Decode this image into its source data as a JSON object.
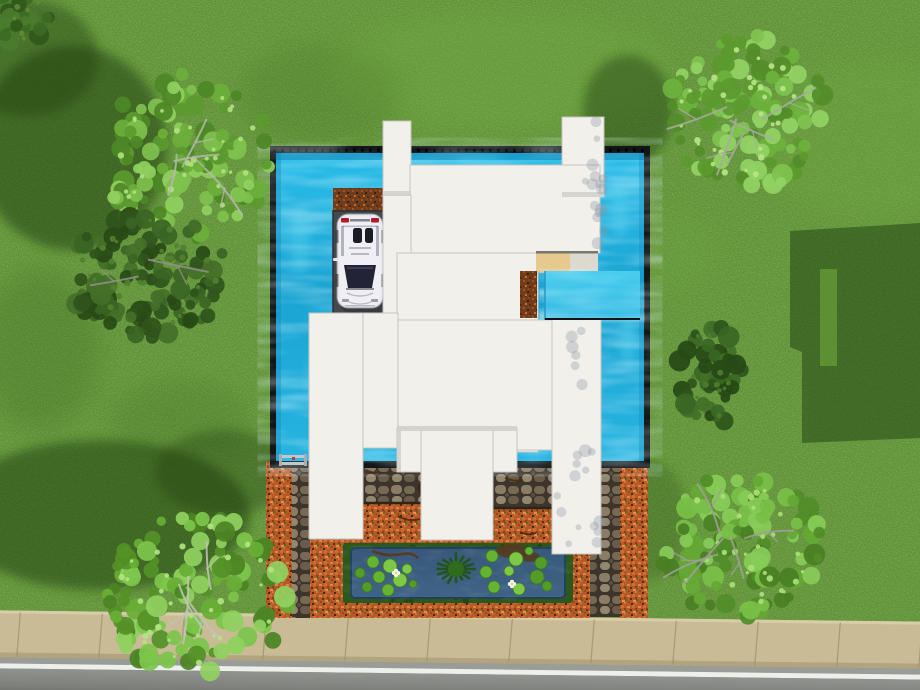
{
  "scene": {
    "width": 920,
    "height": 690,
    "terrain": {
      "grass_base": "#5d9034",
      "grass_light": "#76ad45",
      "grass_dark": "#3f6a22",
      "blotches": [
        [
          500,
          70,
          170,
          60,
          "L",
          0.3
        ],
        [
          870,
          140,
          110,
          80,
          "L",
          0.25
        ],
        [
          420,
          645,
          90,
          28,
          "L",
          0.2
        ],
        [
          660,
          250,
          60,
          40,
          "L",
          0.18
        ],
        [
          320,
          95,
          80,
          50,
          "D",
          0.2
        ],
        [
          180,
          420,
          70,
          40,
          "D",
          0.22
        ],
        [
          40,
          350,
          60,
          80,
          "D",
          0.28
        ]
      ]
    },
    "shadows": {
      "color": "#1c3a0e",
      "blobs": [
        [
          72,
          148,
          95,
          102,
          0.5
        ],
        [
          28,
          58,
          70,
          58,
          0.4
        ],
        [
          628,
          110,
          45,
          55,
          0.42
        ],
        [
          100,
          515,
          150,
          75,
          0.5
        ],
        [
          225,
          472,
          70,
          42,
          0.35
        ],
        [
          648,
          520,
          40,
          60,
          0.22
        ]
      ],
      "house_shadow_path": "M790,231 L920,223 L920,438 L802,443 L802,352 L790,347 Z",
      "house_shadow_opacity": 0.48,
      "slot": [
        820,
        269,
        17,
        97
      ],
      "slot_color": "#5f9233"
    },
    "street": {
      "rotate": 0.7,
      "sidewalk": [
        -10,
        616,
        940,
        48
      ],
      "sidewalk_color": "#c9bb95",
      "lip_color": "#d9cda9",
      "shade_color": "#b2a47e",
      "joint_color": "#a2946f",
      "joint_start": 20,
      "joint_step": 82,
      "curb": [
        -10,
        663,
        940,
        6
      ],
      "curb_color": "#9a9c98",
      "line": [
        -10,
        669,
        940,
        5
      ],
      "line_color": "#edefec",
      "asphalt": [
        -10,
        674,
        940,
        30
      ],
      "asphalt_top": "#90938f",
      "asphalt_bottom": "#5e615a"
    },
    "pool": {
      "frame": [
        270,
        146,
        380,
        322
      ],
      "frame_color": "#12161a",
      "water": [
        276,
        153,
        368,
        308
      ],
      "water_top": "#2abde9",
      "water_mid": "#1ba4d2",
      "water_bottom": "#27b4e1",
      "tick_y": 150.5,
      "inner_shadow_color": "#0b84b4",
      "streak_color": "#63d8f4",
      "streaks": [
        [
          300,
          240,
          10,
          34
        ],
        [
          316,
          380,
          8,
          28
        ],
        [
          620,
          210,
          9,
          30
        ],
        [
          628,
          340,
          8,
          26
        ],
        [
          480,
          160,
          26,
          5
        ],
        [
          535,
          456,
          14,
          4
        ],
        [
          380,
          455,
          12,
          4
        ]
      ],
      "inlet": [
        545,
        271,
        95,
        49
      ],
      "inlet_top": "#49cdef",
      "inlet_bottom": "#2fb9e2",
      "ladder": {
        "x": 281,
        "y": 452,
        "rail": "#c3c6ca",
        "post": "#a9acb0",
        "accent": "#c0392b"
      }
    },
    "ground": {
      "mulch": [
        [
          266,
          462,
          26,
          156
        ],
        [
          310,
          462,
          280,
          156
        ],
        [
          620,
          468,
          28,
          150
        ]
      ],
      "stone": [
        [
          292,
          464,
          18,
          154
        ],
        [
          360,
          464,
          64,
          40
        ],
        [
          490,
          467,
          64,
          42
        ],
        [
          590,
          468,
          30,
          149
        ]
      ],
      "edging": [
        [
          360,
          503,
          424,
          503
        ],
        [
          490,
          508,
          554,
          508
        ]
      ],
      "edging_color": "#2f2517",
      "debris_color": "#4a2a10",
      "debris": [
        "M330,492 q8,5 16,2",
        "M398,516 q10,6 22,3",
        "M505,478 q9,4 18,2",
        "M520,532 q8,4 16,1",
        "M366,470 q7,4 14,2"
      ],
      "leaf_clump": [
        428,
        489,
        11,
        8
      ],
      "leaf_color": "#2c2314"
    },
    "pond": {
      "border": [
        343,
        543,
        230,
        60
      ],
      "border_color": "#2b591b",
      "border_dot": "#1e4312",
      "water": [
        351,
        548,
        214,
        50
      ],
      "water_top": "#37587a",
      "water_bottom": "#3f6386",
      "water_edge": "#24415c",
      "pad_colors": [
        "#64b431",
        "#7dc947",
        "#529c27"
      ],
      "pad_stroke": "#3c7c1d",
      "pads_left": [
        [
          373,
          562,
          6
        ],
        [
          390,
          566,
          7
        ],
        [
          360,
          573,
          5
        ],
        [
          379,
          577,
          6
        ],
        [
          400,
          580,
          7
        ],
        [
          367,
          587,
          5
        ],
        [
          388,
          590,
          6
        ],
        [
          407,
          569,
          5
        ],
        [
          413,
          584,
          4
        ]
      ],
      "pads_right": [
        [
          492,
          556,
          6
        ],
        [
          516,
          559,
          7
        ],
        [
          541,
          563,
          6
        ],
        [
          486,
          572,
          6
        ],
        [
          509,
          571,
          5
        ],
        [
          537,
          577,
          7
        ],
        [
          494,
          587,
          6
        ],
        [
          519,
          589,
          6
        ],
        [
          547,
          586,
          5
        ],
        [
          529,
          551,
          4
        ]
      ],
      "plant": {
        "cx": 456,
        "cy": 569,
        "spikes": 16,
        "r1": 8,
        "r2": 24,
        "color": "#1f5313",
        "core": "#2e6b1a"
      },
      "flowers": [
        [
          396,
          573
        ],
        [
          512,
          584
        ]
      ],
      "flower_color": "#f2f4ee",
      "flower_center": "#e8d44a",
      "twig_color": "#58391b",
      "twigs": [
        "M372,551 q14,6 30,3 q10,-2 16,4",
        "M497,548 q16,8 34,6"
      ],
      "twig_blobs": [
        [
          512,
          551,
          16,
          7
        ],
        [
          530,
          557,
          10,
          5
        ]
      ]
    },
    "driveway": {
      "rect": [
        333,
        211,
        53,
        104
      ],
      "color": "#45494e",
      "edge_color": "#2c2f33",
      "dirt_top": [
        333,
        188,
        53,
        24
      ]
    },
    "car": {
      "x": 337,
      "y": 214,
      "w": 46,
      "h": 94,
      "body": "#e7e7ed",
      "body_hi": "#f1f1f6",
      "outline": "#94959e",
      "glass": "#232338",
      "seat": "#1c1c26",
      "tail": "#b01c26",
      "trim": "#b9bac3",
      "light": "#9a9ba6",
      "wheel": "#1e1e1e"
    },
    "house": {
      "fill": "#f1f0ea",
      "stroke": "#c6c5c0",
      "rects": [
        [
          383,
          121,
          28,
          75,
          "tower-left"
        ],
        [
          562,
          117,
          42,
          80,
          "tower-right"
        ],
        [
          410,
          165,
          190,
          88,
          "roof-top-slab"
        ],
        [
          383,
          195,
          28,
          253,
          "roof-left-column"
        ],
        [
          397,
          253,
          141,
          199,
          "roof-main"
        ],
        [
          397,
          320,
          155,
          130,
          "roof-main-lower"
        ],
        [
          309,
          313,
          54,
          226,
          "wing-left"
        ],
        [
          363,
          313,
          35,
          135,
          "roof-left-mid"
        ],
        [
          552,
          318,
          49,
          236,
          "wing-right"
        ],
        [
          397,
          428,
          120,
          44,
          "roof-center-ext"
        ],
        [
          421,
          428,
          72,
          112,
          "roof-center-lower"
        ]
      ],
      "seams": [
        [
          411,
          196,
          411,
          252
        ],
        [
          363,
          314,
          363,
          447
        ],
        [
          364,
          313,
          397,
          313
        ],
        [
          410,
          253,
          536,
          253
        ],
        [
          552,
          320,
          552,
          450
        ]
      ],
      "bands": [
        [
          397,
          426,
          120,
          5
        ],
        [
          397,
          426,
          4,
          46
        ],
        [
          384,
          191,
          27,
          5
        ],
        [
          562,
          192,
          42,
          5
        ]
      ],
      "band_color": "#d2d1cc",
      "deck": {
        "base": [
          536,
          252,
          62,
          21
        ],
        "left_color": "#e5c98e",
        "right_color": "#dcd9cf",
        "top_color": "#77776f",
        "bottom_color": "#bdbcb6"
      },
      "dirt_strip": [
        520,
        271,
        17,
        47
      ],
      "dapple_color": "#8e95a3",
      "dapples": [
        [
          556,
          448,
          44,
          96,
          14,
          91
        ],
        [
          584,
          120,
          20,
          72,
          9,
          92
        ],
        [
          594,
          196,
          12,
          48,
          6,
          93
        ],
        [
          566,
          330,
          26,
          60,
          6,
          94
        ]
      ]
    },
    "trees": [
      {
        "name": "tree-top-left",
        "cx": 187,
        "cy": 158,
        "rx": 92,
        "ry": 92,
        "seed": 11,
        "twigs": 4,
        "twig_color": "#b6b7af",
        "palette": [
          "#6cae3a",
          "#7fc14e",
          "#5b9a2f",
          "#8fd05f",
          "#4e8826"
        ],
        "hi": "#b2e17f"
      },
      {
        "name": "tree-top-right",
        "cx": 748,
        "cy": 112,
        "rx": 86,
        "ry": 86,
        "seed": 22,
        "twigs": 5,
        "twig_color": "#a9aaa2",
        "palette": [
          "#6db13c",
          "#80c350",
          "#5b9a2f",
          "#92d264",
          "#538d29"
        ],
        "hi": "#b8e588"
      },
      {
        "name": "tree-bottom-left",
        "cx": 198,
        "cy": 597,
        "rx": 100,
        "ry": 90,
        "seed": 33,
        "twigs": 4,
        "twig_color": "#c2c3bb",
        "palette": [
          "#68ae36",
          "#7dc54b",
          "#549127",
          "#90d160",
          "#4b8423"
        ],
        "hi": "#b5e484"
      },
      {
        "name": "tree-bottom-right",
        "cx": 740,
        "cy": 545,
        "rx": 88,
        "ry": 78,
        "seed": 44,
        "twigs": 5,
        "twig_color": "#9fa098",
        "palette": [
          "#65a835",
          "#78bf47",
          "#518d28",
          "#88cb58",
          "#497f22"
        ],
        "hi": "#ace07a"
      },
      {
        "name": "bush-right-mid",
        "cx": 712,
        "cy": 374,
        "rx": 37,
        "ry": 56,
        "seed": 55,
        "twigs": 0,
        "twig_color": "#8f9089",
        "palette": [
          "#2e541b",
          "#3a6623",
          "#274916",
          "#447029"
        ],
        "hi": "#4f7d2e"
      },
      {
        "name": "tree-left-shadowed",
        "cx": 148,
        "cy": 276,
        "rx": 86,
        "ry": 70,
        "seed": 66,
        "twigs": 2,
        "twig_color": "#90918a",
        "palette": [
          "#2f541c",
          "#3a6424",
          "#284a15",
          "#456f28"
        ],
        "hi": "#527f30"
      },
      {
        "name": "corner-canopy",
        "cx": 14,
        "cy": 16,
        "rx": 40,
        "ry": 34,
        "seed": 77,
        "twigs": 0,
        "twig_color": "#8f9089",
        "palette": [
          "#3c6a23",
          "#4a7c2c",
          "#31581b"
        ],
        "hi": "#5c8c33"
      }
    ]
  }
}
